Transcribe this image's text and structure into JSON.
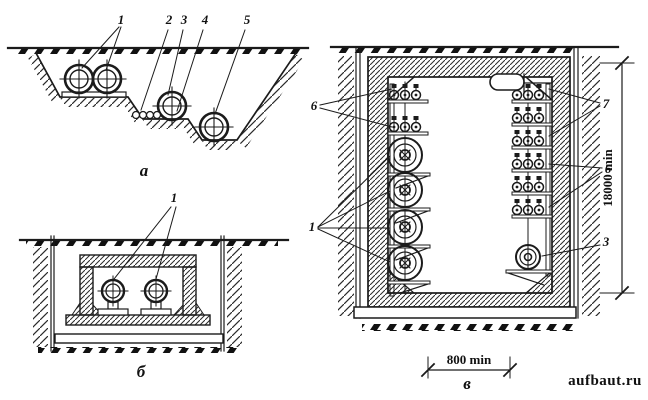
{
  "figures": {
    "a": {
      "label": "а",
      "callouts": {
        "c1": "1",
        "c2": "2",
        "c3": "3",
        "c4": "4",
        "c5": "5"
      }
    },
    "b": {
      "label": "б",
      "callouts": {
        "c1": "1"
      }
    },
    "v": {
      "label": "в",
      "callouts": {
        "left6": "6",
        "left1": "1",
        "right7": "7",
        "right6": "6",
        "right3": "3"
      },
      "dimensions": {
        "width": "800 min",
        "depth": "18000 min"
      }
    }
  },
  "watermark": {
    "text": "aufbaut.ru",
    "color": "#a6a6a6"
  },
  "colors": {
    "ink": "#1b1b1b",
    "paper": "#ffffff"
  }
}
